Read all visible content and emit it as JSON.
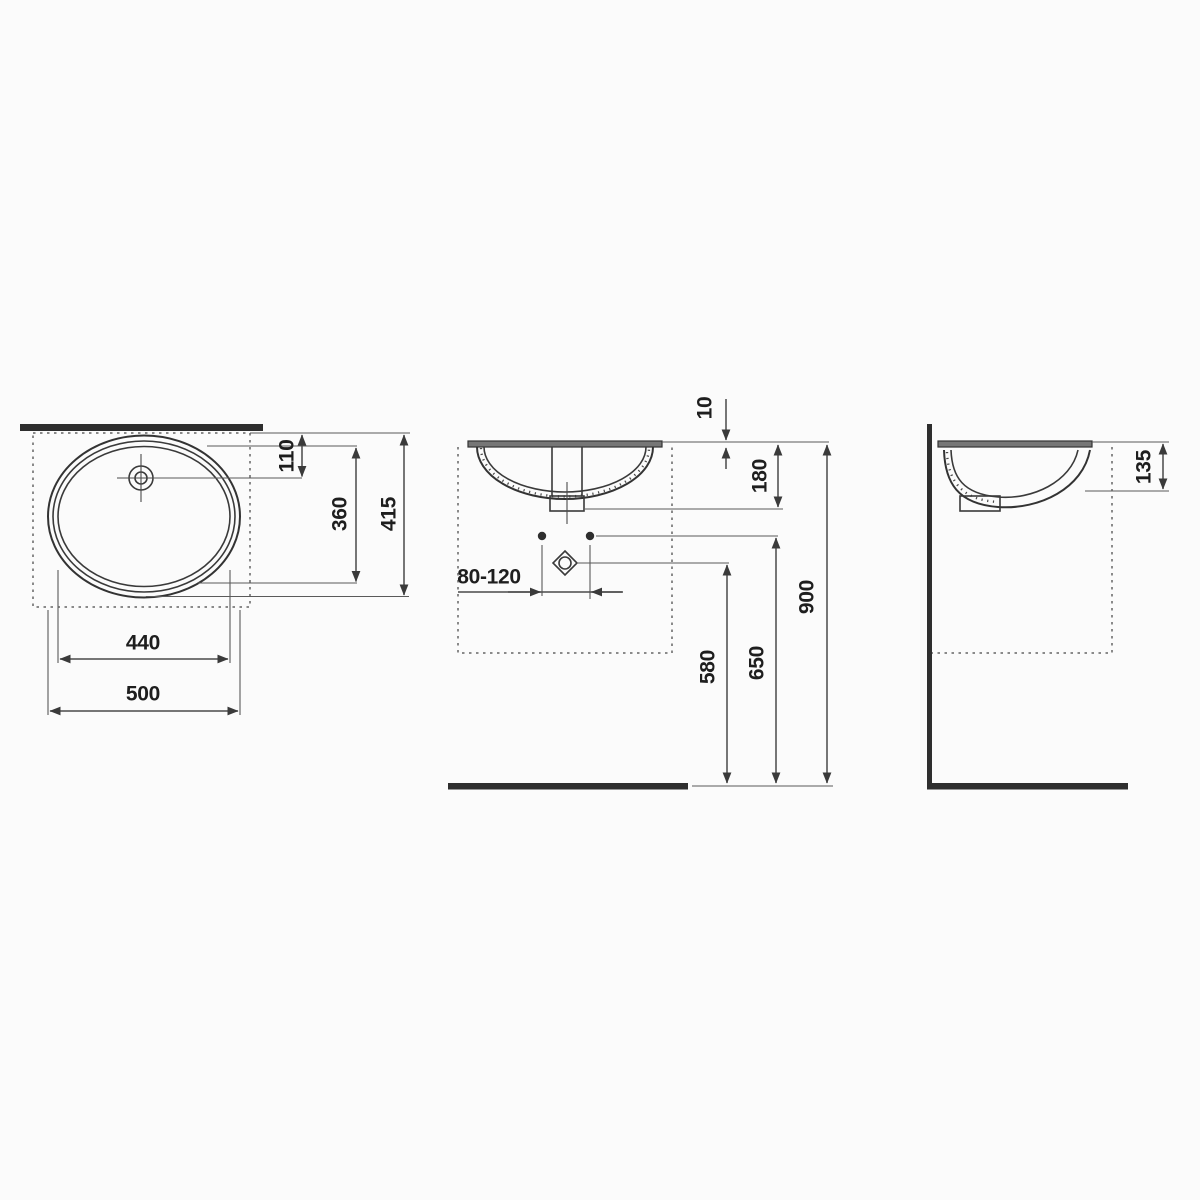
{
  "top_view": {
    "dim_tap_offset": "110",
    "dim_bowl_length": "360",
    "dim_overall_length": "415",
    "dim_bowl_width": "440",
    "dim_overall_width": "500"
  },
  "front_view": {
    "dim_rim_gap": "10",
    "dim_basin_depth": "180",
    "dim_fixing_centres": "80-120",
    "dim_drain_height": "580",
    "dim_fixing_height": "650",
    "dim_rim_height": "900"
  },
  "side_view": {
    "dim_inner_depth": "135"
  },
  "colors": {
    "background": "#fbfbfb",
    "outline": "#333333",
    "dimension": "#4a4a4a",
    "label": "#1e1e1e",
    "solid_fill": "#2e2e2e",
    "dashed": "#8a8a8a"
  }
}
